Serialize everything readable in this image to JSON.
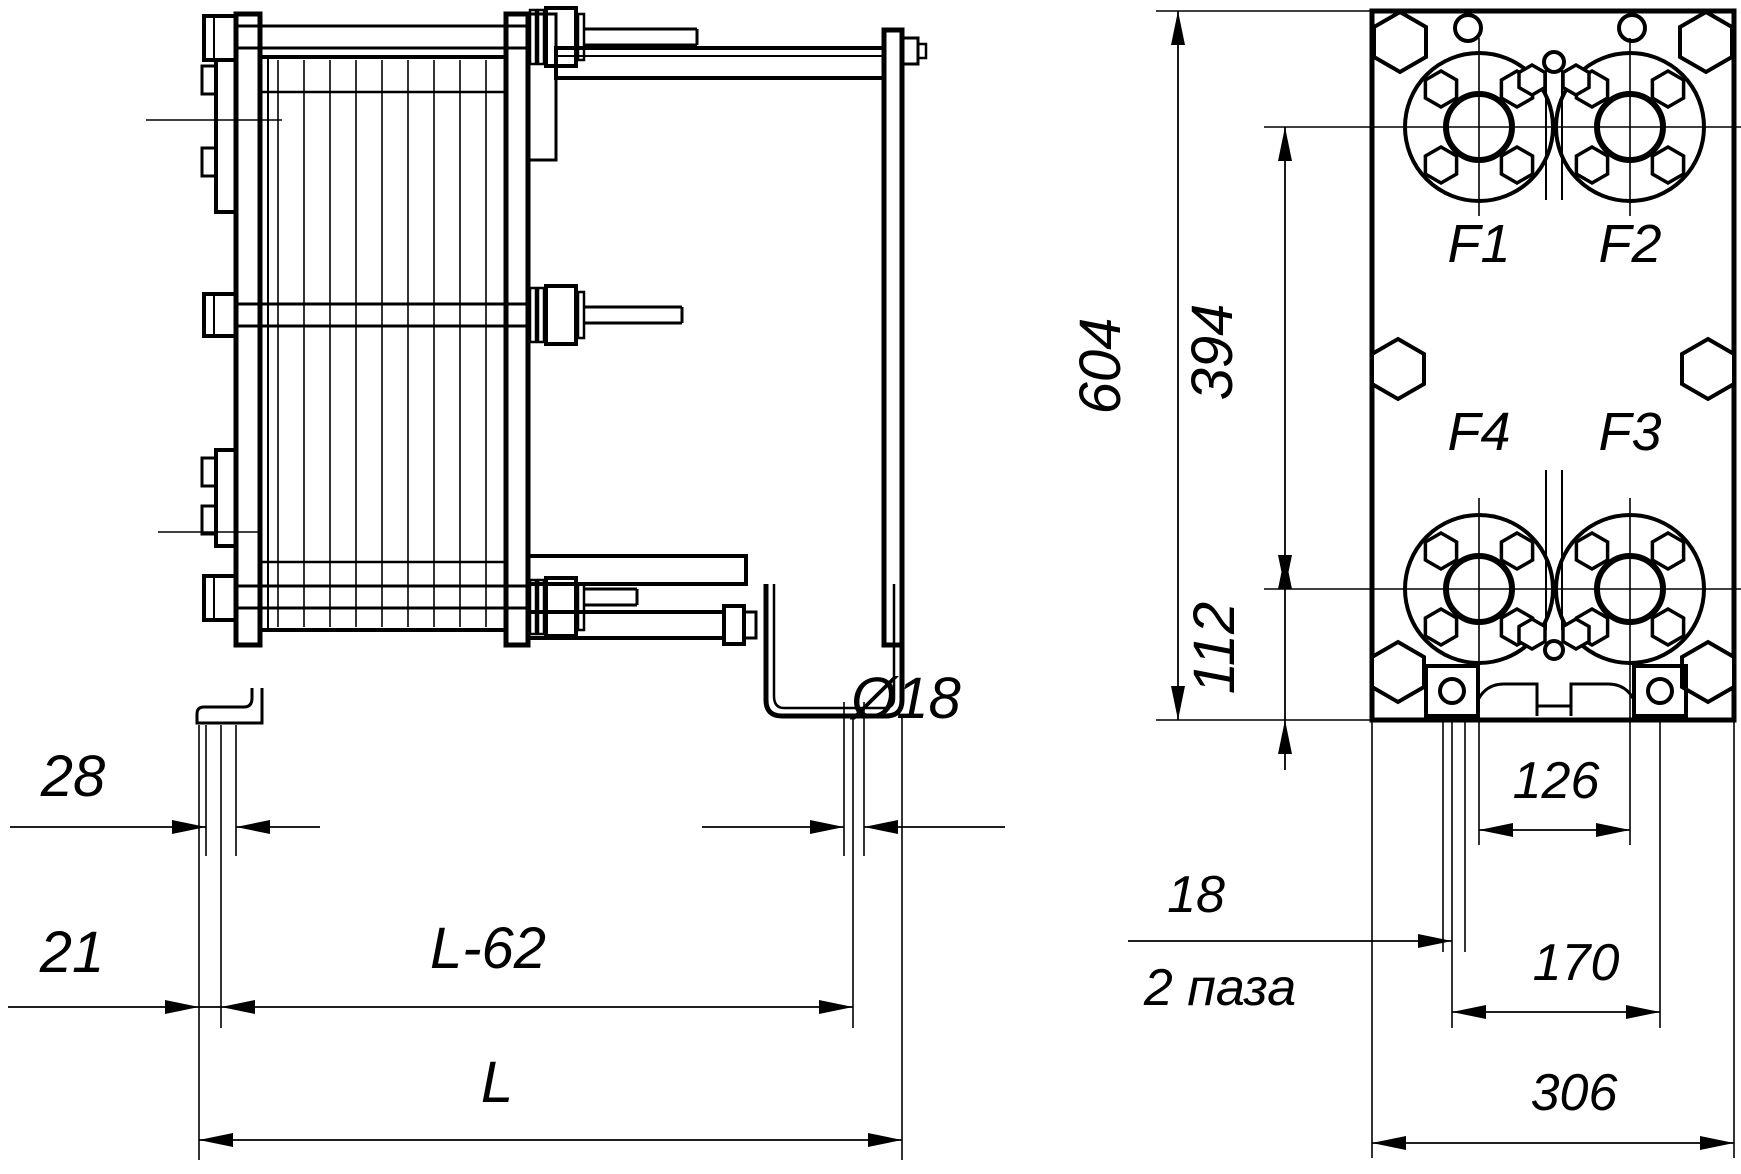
{
  "drawing": {
    "title": "plate heat exchanger dimensional drawing",
    "colors": {
      "line": "#000000",
      "background": "#ffffff"
    },
    "side_view": {
      "dim_slot_width": "28",
      "dim_hole_diameter": "Ø18",
      "dim_foot_offset": "21",
      "dim_bolt_span": "L-62",
      "dim_total_length": "L"
    },
    "front_view": {
      "dim_height": "604",
      "dim_ports_vertical": "394",
      "dim_port_bottom": "112",
      "dim_ports_horizontal": "126",
      "dim_slot": "18",
      "note_slots": "2 паза",
      "dim_feet_span": "170",
      "dim_width": "306",
      "ports": {
        "f1": "F1",
        "f2": "F2",
        "f3": "F3",
        "f4": "F4"
      }
    }
  }
}
